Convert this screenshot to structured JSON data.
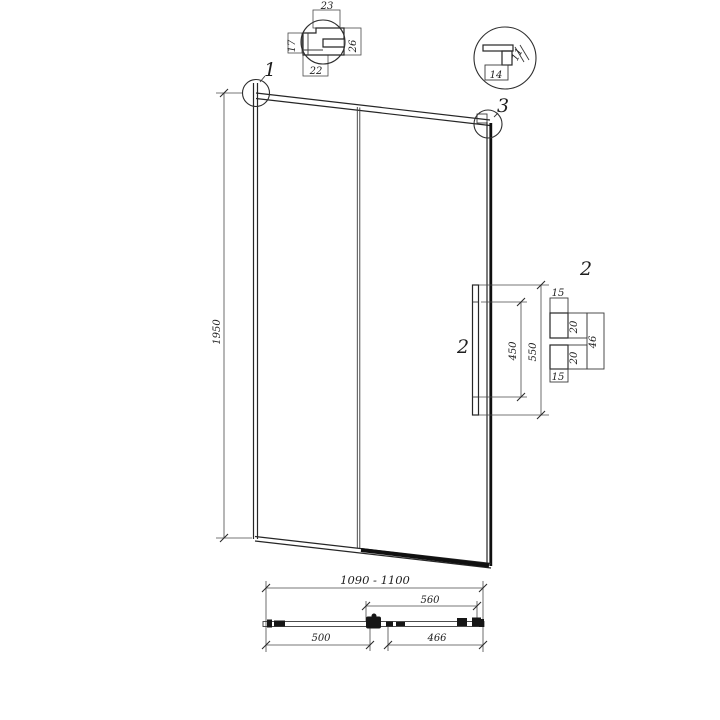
{
  "colors": {
    "ink": "#1f1f1f",
    "line": "#262626",
    "heavy": "#101010",
    "background": "#ffffff"
  },
  "callouts": {
    "c1": "1",
    "c2_handle": "2",
    "c2_detail": "2",
    "c3": "3"
  },
  "dims": {
    "height": "1950",
    "width_range": "1090 - 1100",
    "plan_560": "560",
    "plan_500": "500",
    "plan_466": "466",
    "handle_450": "450",
    "handle_550": "550",
    "handle_15_top": "15",
    "handle_15_bottom": "15",
    "handle_20_upper": "20",
    "handle_20_lower": "20",
    "handle_46": "46",
    "profile_23": "23",
    "profile_22": "22",
    "profile_26": "26",
    "profile_17": "17",
    "bracket_14": "14",
    "bracket_11": "11"
  }
}
